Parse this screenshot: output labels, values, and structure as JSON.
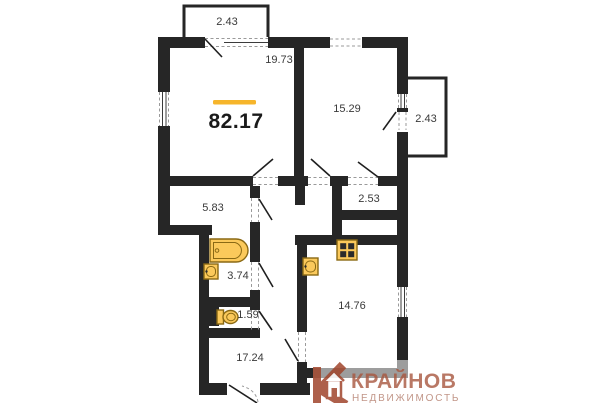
{
  "floor_plan": {
    "total_area_label": "82.17",
    "rooms": {
      "balcony_top": "2.43",
      "living": "19.73",
      "bedroom": "15.29",
      "balcony_right": "2.43",
      "cabinet": "5.83",
      "storage": "2.53",
      "bathroom": "3.74",
      "wc": "1.59",
      "kitchen": "14.76",
      "hallway": "17.24"
    },
    "colors": {
      "wall": "#262626",
      "fixture_fill": "#FBC95B",
      "fixture_stroke": "#8A6914",
      "accent_bar": "#F6B52B"
    }
  },
  "watermark": {
    "brand": "КРАЙНОВ",
    "tagline": "НЕДВИЖИМОСТЬ",
    "color": "#A0452C"
  }
}
